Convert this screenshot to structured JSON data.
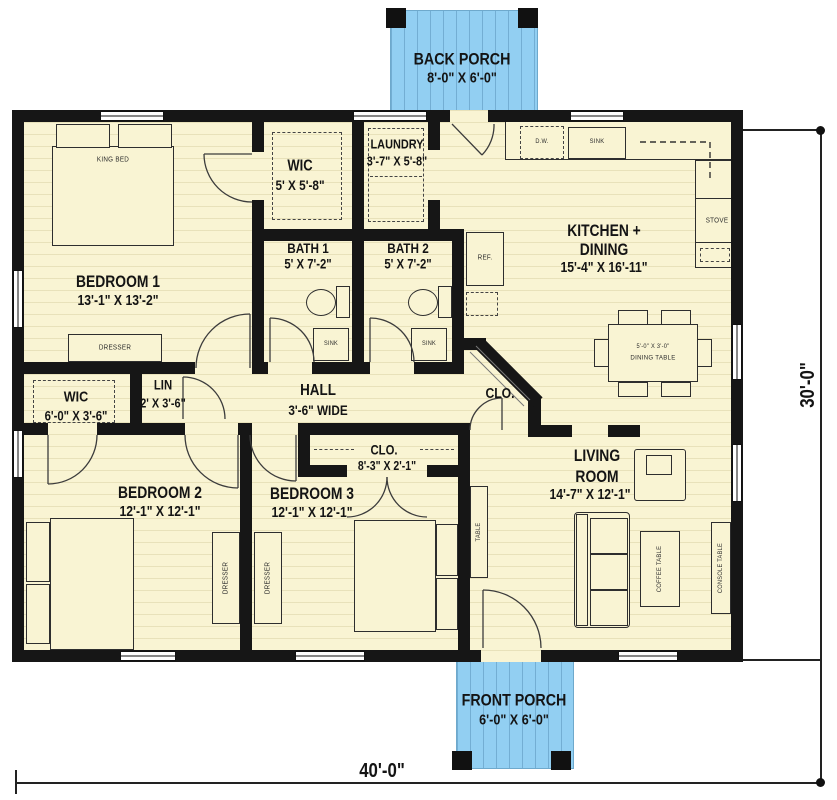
{
  "porches": {
    "back": {
      "name": "BACK PORCH",
      "dims": "8'-0\" X 6'-0\""
    },
    "front": {
      "name": "FRONT PORCH",
      "dims": "6'-0\" X 6'-0\""
    }
  },
  "rooms": {
    "bedroom1": {
      "name": "BEDROOM 1",
      "dims": "13'-1\" X 13'-2\""
    },
    "wic1": {
      "name": "WIC",
      "dims": "5' X 5'-8\""
    },
    "laundry": {
      "name": "LAUNDRY",
      "dims": "3'-7\" X 5'-8\""
    },
    "bath1": {
      "name": "BATH 1",
      "dims": "5' X 7'-2\""
    },
    "bath2": {
      "name": "BATH 2",
      "dims": "5' X 7'-2\""
    },
    "kitchen": {
      "name_line1": "KITCHEN +",
      "name_line2": "DINING",
      "dims": "15'-4\" X 16'-11\""
    },
    "hall": {
      "name": "HALL",
      "dims": "3'-6\" WIDE"
    },
    "wic2": {
      "name": "WIC",
      "dims": "6'-0\" X 3'-6\""
    },
    "lin": {
      "name": "LIN",
      "dims": "2' X 3'-6\""
    },
    "clo_corner": {
      "name": "CLO."
    },
    "clo_bed3": {
      "name": "CLO.",
      "dims": "8'-3\" X 2'-1\""
    },
    "bedroom2": {
      "name": "BEDROOM 2",
      "dims": "12'-1\" X 12'-1\""
    },
    "bedroom3": {
      "name": "BEDROOM 3",
      "dims": "12'-1\" X 12'-1\""
    },
    "living": {
      "name_line1": "LIVING",
      "name_line2": "ROOM",
      "dims": "14'-7\" X 12'-1\""
    }
  },
  "furniture": {
    "king_bed": "KING BED",
    "dresser": "DRESSER",
    "dw": "D.W.",
    "sink": "SINK",
    "stove": "STOVE",
    "ref": "REF.",
    "dining_size": "5'-0\" X 3'-0\"",
    "dining_table": "DINING TABLE",
    "coffee_table": "COFFEE TABLE",
    "console_table": "CONSOLE TABLE",
    "table": "TABLE"
  },
  "dimensions": {
    "overall_width": "40'-0\"",
    "overall_height": "30'-0\""
  },
  "colors": {
    "floor": "#f9f4d3",
    "porch": "#92cff2",
    "wall": "#161616"
  }
}
